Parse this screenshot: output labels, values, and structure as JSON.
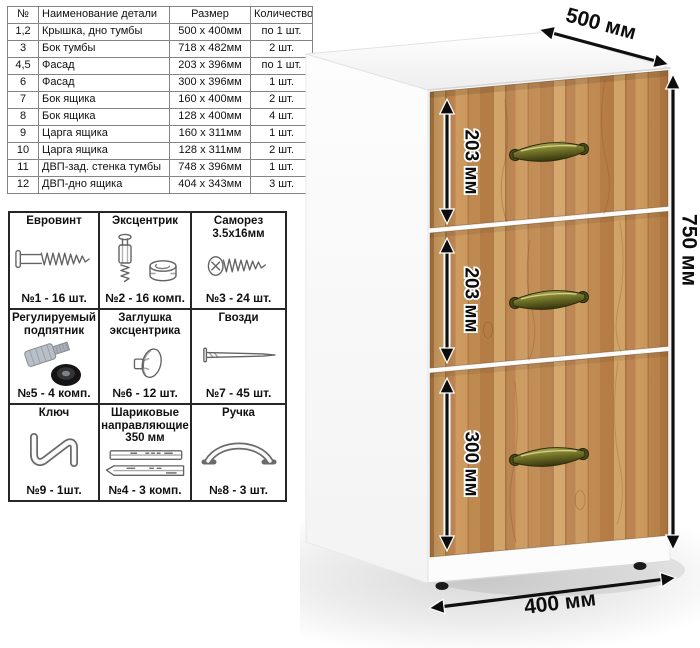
{
  "parts_table": {
    "headers": [
      "№",
      "Наименование детали",
      "Размер",
      "Количество"
    ],
    "rows": [
      [
        "1,2",
        "Крышка, дно тумбы",
        "500 х 400мм",
        "по 1 шт."
      ],
      [
        "3",
        "Бок тумбы",
        "718 х 482мм",
        "2 шт."
      ],
      [
        "4,5",
        "Фасад",
        "203 х 396мм",
        "по 1 шт."
      ],
      [
        "6",
        "Фасад",
        "300 х 396мм",
        "1 шт."
      ],
      [
        "7",
        "Бок ящика",
        "160 х 400мм",
        "2 шт."
      ],
      [
        "8",
        "Бок ящика",
        "128 х 400мм",
        "4 шт."
      ],
      [
        "9",
        "Царга ящика",
        "160 х 311мм",
        "1 шт."
      ],
      [
        "10",
        "Царга ящика",
        "128 х 311мм",
        "2 шт."
      ],
      [
        "11",
        "ДВП-зад. стенка тумбы",
        "748 х 396мм",
        "1 шт."
      ],
      [
        "12",
        "ДВП-дно ящика",
        "404 х 343мм",
        "3 шт."
      ]
    ]
  },
  "hardware": {
    "items": [
      {
        "title": "Евровинт",
        "count": "№1 - 16 шт.",
        "icon": "euro-screw"
      },
      {
        "title": "Эксцентрик",
        "count": "№2 - 16 комп.",
        "icon": "eccentric-cam"
      },
      {
        "title": "Саморез 3.5х16мм",
        "count": "№3 - 24 шт.",
        "icon": "self-tapping-screw"
      },
      {
        "title": "Регулируемый подпятник",
        "count": "№5 - 4 комп.",
        "icon": "adjustable-foot"
      },
      {
        "title": "Заглушка эксцентрика",
        "count": "№6 - 12 шт.",
        "icon": "cam-cover"
      },
      {
        "title": "Гвозди",
        "count": "№7 - 45 шт.",
        "icon": "nail"
      },
      {
        "title": "Ключ",
        "count": "№9 - 1шт.",
        "icon": "hex-key"
      },
      {
        "title": "Шариковые направляющие 350 мм",
        "count": "№4 - 3 комп.",
        "icon": "ball-bearing-slides"
      },
      {
        "title": "Ручка",
        "count": "№8 - 3 шт.",
        "icon": "handle"
      }
    ]
  },
  "cabinet": {
    "depth_label": "500 мм",
    "height_label": "750 мм",
    "width_label": "400 мм",
    "drawer_labels": [
      "203 мм",
      "203 мм",
      "300 мм"
    ],
    "colors": {
      "wood": "#c69155",
      "handle_bronze": "#6a6a24",
      "cabinet_body": "#ffffff"
    }
  }
}
